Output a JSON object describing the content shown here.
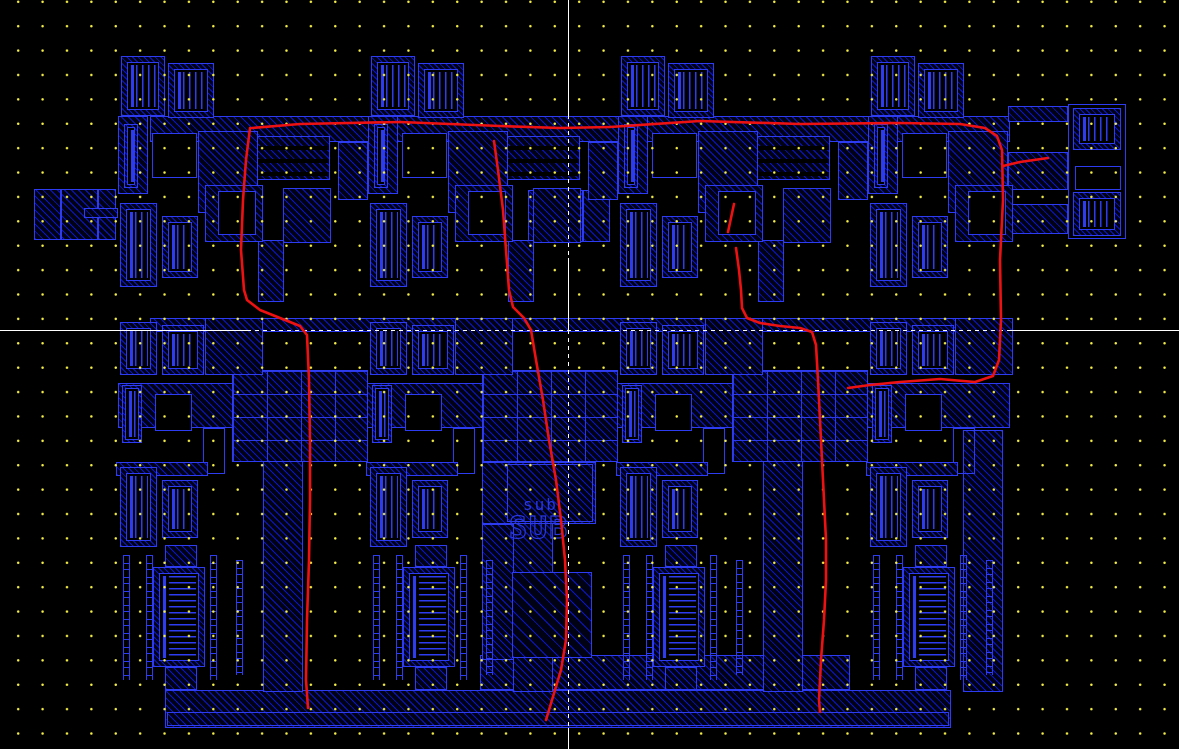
{
  "screen": {
    "width": 1179,
    "height": 749,
    "background": "#000000"
  },
  "palette": {
    "shape_border": "#2d3cf0",
    "hatch_line": "#0a17c9",
    "hatch_fill": "#010214",
    "grid_dot": "#f5ef46",
    "crosshair": "#ffffff",
    "annotation_red": "#ee1111",
    "label_blue": "#2a38e0"
  },
  "grid": {
    "spacing_x": 24.4,
    "spacing_y": 24.4,
    "offset_x": 6,
    "offset_y": 14
  },
  "crosshair": {
    "vertical_x": 568,
    "horizontal_y": 330,
    "v_segments": [
      {
        "y1": 0,
        "y2": 115,
        "style": "solid"
      },
      {
        "y1": 115,
        "y2": 258,
        "style": "dash"
      },
      {
        "y1": 258,
        "y2": 330,
        "style": "solid"
      },
      {
        "y1": 330,
        "y2": 728,
        "style": "dash"
      },
      {
        "y1": 728,
        "y2": 749,
        "style": "solid"
      }
    ],
    "h_segments": [
      {
        "x1": 0,
        "x2": 247,
        "style": "solid"
      },
      {
        "x1": 247,
        "x2": 1008,
        "style": "dash"
      },
      {
        "x1": 1008,
        "x2": 1179,
        "style": "solid"
      }
    ]
  },
  "labels": [
    {
      "text": "sub",
      "x": 523,
      "y": 497,
      "size": 16,
      "style": "plain"
    },
    {
      "text": "SUB",
      "x": 509,
      "y": 514,
      "size": 30,
      "style": "outline"
    }
  ],
  "red_annotations": [
    [
      [
        252,
        128
      ],
      [
        300,
        124
      ],
      [
        400,
        122
      ],
      [
        500,
        126
      ],
      [
        560,
        128
      ],
      [
        610,
        127
      ],
      [
        700,
        121
      ],
      [
        800,
        124
      ],
      [
        900,
        123
      ],
      [
        960,
        124
      ],
      [
        985,
        128
      ],
      [
        997,
        136
      ],
      [
        1002,
        150
      ],
      [
        1003,
        200
      ],
      [
        1000,
        260
      ],
      [
        1001,
        320
      ],
      [
        999,
        360
      ],
      [
        993,
        376
      ],
      [
        975,
        382
      ],
      [
        940,
        379
      ],
      [
        900,
        382
      ],
      [
        870,
        385
      ],
      [
        848,
        388
      ]
    ],
    [
      [
        1003,
        166
      ],
      [
        1020,
        162
      ],
      [
        1048,
        158
      ]
    ],
    [
      [
        250,
        128
      ],
      [
        246,
        160
      ],
      [
        243,
        200
      ],
      [
        241,
        250
      ],
      [
        244,
        290
      ],
      [
        247,
        300
      ],
      [
        260,
        310
      ],
      [
        280,
        318
      ],
      [
        300,
        326
      ],
      [
        307,
        335
      ],
      [
        309,
        380
      ],
      [
        310,
        440
      ],
      [
        310,
        500
      ],
      [
        309,
        560
      ],
      [
        307,
        620
      ],
      [
        306,
        680
      ],
      [
        308,
        708
      ]
    ],
    [
      [
        494,
        141
      ],
      [
        498,
        170
      ],
      [
        503,
        210
      ],
      [
        506,
        250
      ],
      [
        509,
        290
      ],
      [
        513,
        307
      ],
      [
        524,
        318
      ],
      [
        531,
        330
      ],
      [
        536,
        360
      ],
      [
        543,
        400
      ],
      [
        549,
        440
      ],
      [
        556,
        480
      ],
      [
        561,
        520
      ],
      [
        565,
        560
      ],
      [
        567,
        600
      ],
      [
        566,
        640
      ],
      [
        561,
        670
      ],
      [
        552,
        700
      ],
      [
        546,
        720
      ]
    ],
    [
      [
        734,
        204
      ],
      [
        731,
        218
      ],
      [
        728,
        232
      ]
    ],
    [
      [
        736,
        248
      ],
      [
        739,
        270
      ],
      [
        741,
        290
      ],
      [
        742,
        308
      ],
      [
        747,
        318
      ],
      [
        760,
        323
      ],
      [
        780,
        326
      ],
      [
        800,
        328
      ],
      [
        812,
        332
      ],
      [
        816,
        345
      ],
      [
        818,
        380
      ],
      [
        820,
        420
      ],
      [
        822,
        460
      ],
      [
        824,
        500
      ],
      [
        826,
        540
      ],
      [
        826,
        580
      ],
      [
        824,
        620
      ],
      [
        821,
        660
      ],
      [
        819,
        700
      ],
      [
        820,
        712
      ]
    ]
  ],
  "layout": {
    "group_offsets": [
      0,
      250,
      500,
      750
    ],
    "bridge_offsets": [
      0,
      250,
      500
    ],
    "group_rects": [
      [
        121,
        56,
        44,
        60,
        "combV"
      ],
      [
        168,
        63,
        46,
        55,
        "combV"
      ],
      [
        118,
        116,
        30,
        78,
        "hatch"
      ],
      [
        124,
        124,
        14,
        64,
        "combVn"
      ],
      [
        152,
        133,
        45,
        45,
        "black"
      ],
      [
        198,
        131,
        60,
        82,
        "hatch"
      ],
      [
        205,
        185,
        58,
        57,
        "hatch"
      ],
      [
        218,
        191,
        38,
        44,
        "black"
      ],
      [
        120,
        203,
        37,
        84,
        "combV"
      ],
      [
        162,
        216,
        36,
        62,
        "combV"
      ],
      [
        120,
        322,
        37,
        53,
        "combV"
      ],
      [
        162,
        325,
        42,
        50,
        "combV"
      ],
      [
        205,
        318,
        58,
        57,
        "hatch"
      ],
      [
        122,
        385,
        20,
        58,
        "combVn"
      ],
      [
        155,
        394,
        37,
        37,
        "black"
      ],
      [
        203,
        428,
        22,
        46,
        "outline"
      ],
      [
        116,
        462,
        92,
        14,
        "hatch"
      ],
      [
        120,
        467,
        37,
        80,
        "combV"
      ],
      [
        162,
        480,
        36,
        58,
        "combV"
      ],
      [
        153,
        567,
        52,
        100,
        "combH"
      ],
      [
        165,
        545,
        32,
        22,
        "hatch"
      ],
      [
        165,
        667,
        32,
        23,
        "hatch"
      ],
      [
        123,
        555,
        7,
        125,
        "dashcol"
      ],
      [
        146,
        555,
        7,
        125,
        "dashcol"
      ],
      [
        210,
        555,
        7,
        125,
        "dashcol"
      ],
      [
        236,
        560,
        7,
        115,
        "dashcol"
      ]
    ],
    "bridge_rects": [
      [
        256,
        136,
        74,
        44,
        "busH"
      ],
      [
        338,
        142,
        30,
        58,
        "hatch"
      ],
      [
        283,
        188,
        48,
        55,
        "hatch"
      ],
      [
        258,
        240,
        26,
        62,
        "hatch"
      ],
      [
        232,
        370,
        136,
        92,
        "busGrid"
      ]
    ],
    "static_rects": [
      [
        150,
        116,
        860,
        26,
        "hatch"
      ],
      [
        118,
        383,
        892,
        45,
        "hatch"
      ],
      [
        150,
        318,
        860,
        14,
        "hatch"
      ],
      [
        480,
        655,
        370,
        35,
        "hatch"
      ],
      [
        165,
        690,
        786,
        38,
        "hatch"
      ],
      [
        167,
        712,
        782,
        14,
        "outline"
      ],
      [
        263,
        430,
        40,
        262,
        "hatch"
      ],
      [
        513,
        430,
        40,
        262,
        "hatch"
      ],
      [
        763,
        430,
        40,
        262,
        "hatch"
      ],
      [
        963,
        430,
        40,
        262,
        "hatch"
      ],
      [
        34,
        189,
        82,
        51,
        "hatch"
      ],
      [
        60,
        190,
        2,
        49,
        "vline"
      ],
      [
        97,
        190,
        2,
        49,
        "vline"
      ],
      [
        84,
        208,
        34,
        10,
        "hatch"
      ],
      [
        528,
        190,
        82,
        52,
        "hatch"
      ],
      [
        554,
        191,
        2,
        50,
        "vline"
      ],
      [
        582,
        191,
        2,
        50,
        "vline"
      ],
      [
        482,
        462,
        114,
        62,
        "hatch"
      ],
      [
        507,
        464,
        86,
        58,
        "outline"
      ],
      [
        482,
        524,
        32,
        136,
        "hatch"
      ],
      [
        512,
        572,
        80,
        86,
        "hatch2"
      ],
      [
        1068,
        104,
        58,
        135,
        "outline"
      ],
      [
        1073,
        108,
        48,
        42,
        "combV"
      ],
      [
        1075,
        166,
        46,
        24,
        "black"
      ],
      [
        1073,
        192,
        48,
        44,
        "combV"
      ],
      [
        1008,
        106,
        60,
        16,
        "hatch"
      ],
      [
        1008,
        152,
        60,
        38,
        "hatch"
      ],
      [
        1008,
        204,
        60,
        30,
        "hatch"
      ]
    ]
  }
}
